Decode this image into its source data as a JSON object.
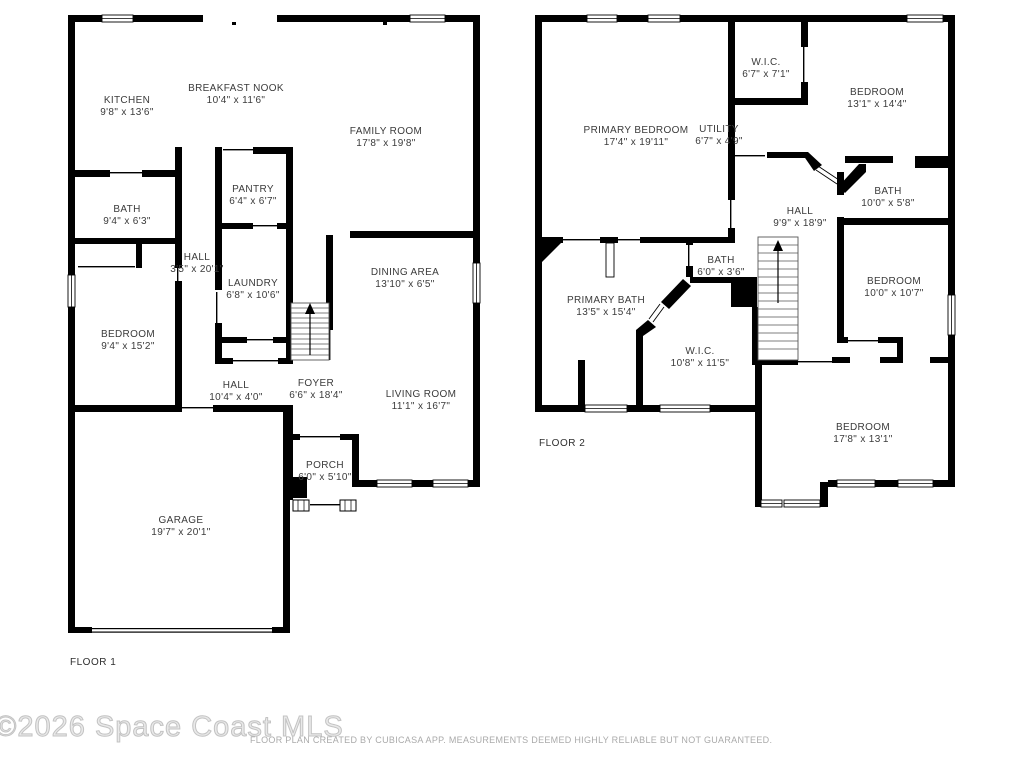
{
  "footer": {
    "watermark": "©2026 Space Coast MLS",
    "disclaimer": "FLOOR PLAN CREATED BY CUBICASA APP. MEASUREMENTS DEEMED HIGHLY RELIABLE BUT NOT GUARANTEED."
  },
  "colors": {
    "wall": "#000000",
    "room_label": "#3b3b3b",
    "watermark": "#c9c9c9",
    "disclaimer": "#aaaaaa"
  },
  "floors": [
    {
      "label": "FLOOR 1",
      "label_x": 70,
      "label_y": 657,
      "rooms": [
        {
          "name": "KITCHEN",
          "dims": "9'8\" x 13'6\"",
          "x": 127,
          "y": 95
        },
        {
          "name": "BREAKFAST NOOK",
          "dims": "10'4\" x 11'6\"",
          "x": 236,
          "y": 83
        },
        {
          "name": "FAMILY ROOM",
          "dims": "17'8\" x 19'8\"",
          "x": 386,
          "y": 126
        },
        {
          "name": "PANTRY",
          "dims": "6'4\" x 6'7\"",
          "x": 253,
          "y": 184
        },
        {
          "name": "BATH",
          "dims": "9'4\" x 6'3\"",
          "x": 127,
          "y": 204
        },
        {
          "name": "HALL",
          "dims": "3'5\" x 20'1\"",
          "x": 197,
          "y": 252
        },
        {
          "name": "LAUNDRY",
          "dims": "6'8\" x 10'6\"",
          "x": 253,
          "y": 278
        },
        {
          "name": "DINING AREA",
          "dims": "13'10\" x 6'5\"",
          "x": 405,
          "y": 267
        },
        {
          "name": "BEDROOM",
          "dims": "9'4\" x 15'2\"",
          "x": 128,
          "y": 329
        },
        {
          "name": "HALL",
          "dims": "10'4\" x 4'0\"",
          "x": 236,
          "y": 380
        },
        {
          "name": "FOYER",
          "dims": "6'6\" x 18'4\"",
          "x": 316,
          "y": 378
        },
        {
          "name": "LIVING ROOM",
          "dims": "11'1\" x 16'7\"",
          "x": 421,
          "y": 389
        },
        {
          "name": "PORCH",
          "dims": "6'0\" x 5'10\"",
          "x": 325,
          "y": 460
        },
        {
          "name": "GARAGE",
          "dims": "19'7\" x 20'1\"",
          "x": 181,
          "y": 515
        }
      ]
    },
    {
      "label": "FLOOR 2",
      "label_x": 539,
      "label_y": 438,
      "rooms": [
        {
          "name": "PRIMARY BEDROOM",
          "dims": "17'4\" x 19'11\"",
          "x": 636,
          "y": 125
        },
        {
          "name": "W.I.C.",
          "dims": "6'7\" x 7'1\"",
          "x": 766,
          "y": 57
        },
        {
          "name": "BEDROOM",
          "dims": "13'1\" x 14'4\"",
          "x": 877,
          "y": 87
        },
        {
          "name": "UTILITY",
          "dims": "6'7\" x 4'9\"",
          "x": 719,
          "y": 124
        },
        {
          "name": "BATH",
          "dims": "10'0\" x 5'8\"",
          "x": 888,
          "y": 186
        },
        {
          "name": "HALL",
          "dims": "9'9\" x 18'9\"",
          "x": 800,
          "y": 206
        },
        {
          "name": "BATH",
          "dims": "6'0\" x 3'6\"",
          "x": 721,
          "y": 255
        },
        {
          "name": "PRIMARY BATH",
          "dims": "13'5\" x 15'4\"",
          "x": 606,
          "y": 295
        },
        {
          "name": "BEDROOM",
          "dims": "10'0\" x 10'7\"",
          "x": 894,
          "y": 276
        },
        {
          "name": "W.I.C.",
          "dims": "10'8\" x 11'5\"",
          "x": 700,
          "y": 346
        },
        {
          "name": "BEDROOM",
          "dims": "17'8\" x 13'1\"",
          "x": 863,
          "y": 422
        }
      ]
    }
  ]
}
